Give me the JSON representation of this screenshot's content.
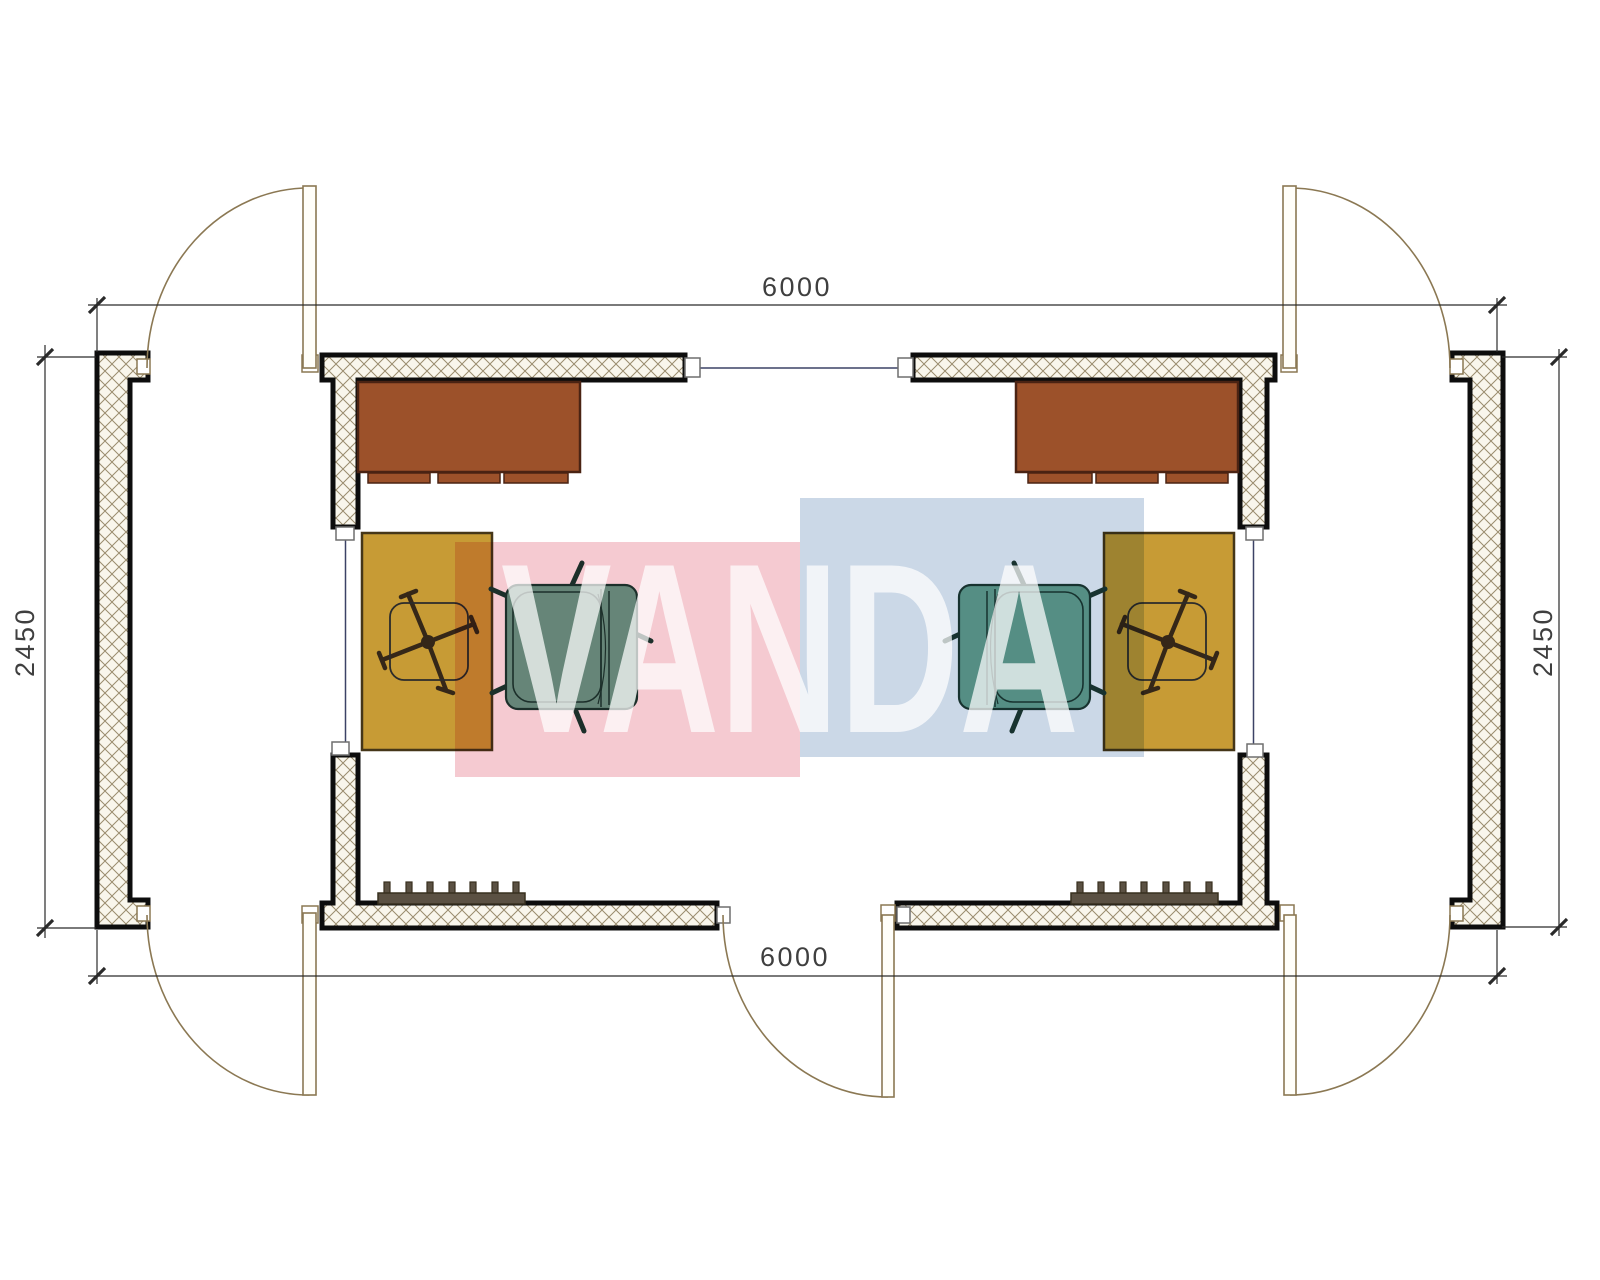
{
  "document": {
    "type": "architectural-floor-plan",
    "description": "Plan of two mirrored modular rooms 6000 x 2450 with corner swing doors, desks, tables, office chairs, armchairs and radiators",
    "units": "mm"
  },
  "dimensions": {
    "top": "6000",
    "bottom": "6000",
    "left": "2450",
    "right": "2450"
  },
  "watermark": {
    "text": "VANDA",
    "pink_block_color": "#f5cad1",
    "blue_block_color": "#cbd8e7"
  },
  "rooms": [
    {
      "name": "left-module",
      "furniture": [
        "desk",
        "table",
        "office-chair",
        "armchair",
        "radiator"
      ],
      "doors": [
        "top-left",
        "bottom-left",
        "bottom-middle"
      ]
    },
    {
      "name": "right-module",
      "furniture": [
        "desk",
        "table",
        "office-chair",
        "armchair",
        "radiator"
      ],
      "doors": [
        "top-right",
        "bottom-right"
      ]
    }
  ],
  "colors": {
    "wall_outline": "#0d0d0d",
    "wall_fill": "#f9f6ec",
    "hatch_line": "#9a8c6e",
    "desk": "#9c512a",
    "table": "#c79b35",
    "armchair": "#6aa892",
    "radiator": "#5b5143",
    "door_line": "#8b7853",
    "window_line": "#3c4266",
    "dimension_line": "#2a2a2a",
    "dimension_text": "#3f3f3f"
  }
}
